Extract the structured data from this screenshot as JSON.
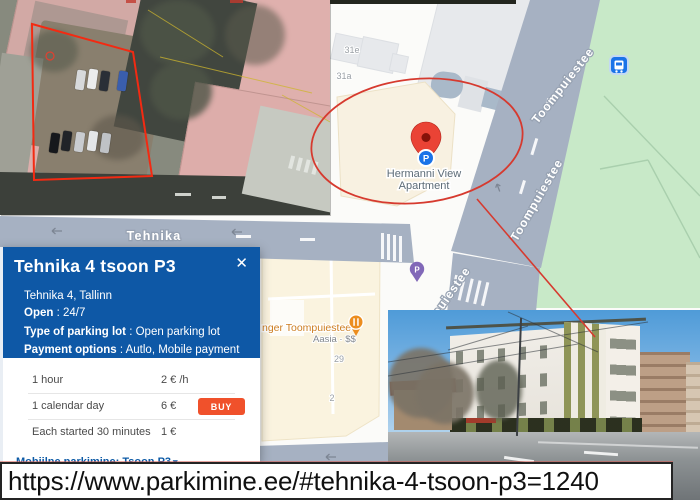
{
  "url_bar": {
    "url": "https://www.parkimine.ee/#tehnika-4-tsoon-p3=1240"
  },
  "map": {
    "street_labels": {
      "tehnika": "Tehnika",
      "toompuiestee_north": "Toompuiestee",
      "toompuiestee_mid": "Toompuiestee",
      "toompuiestee_south": "Toompuiestee"
    },
    "place": {
      "line1": "Hermanni View",
      "line2": "Apartment"
    },
    "restaurant": {
      "name_visible": "nger Toompuiestee",
      "subtitle": "Aasia · $$"
    },
    "addresses": {
      "b31e": "31e",
      "b31a": "31a",
      "b29": "29",
      "b2": "2"
    },
    "parking_pin_letter": "P"
  },
  "card": {
    "title": "Tehnika 4 tsoon P3",
    "close_glyph": "✕",
    "address": "Tehnika 4, Tallinn",
    "sep": " : ",
    "fields": [
      {
        "label": "Open",
        "value": "24/7"
      },
      {
        "label": "Type of parking lot",
        "value": "Open parking lot"
      },
      {
        "label": "Payment options",
        "value": "Autlo, Mobile payment"
      }
    ],
    "prices": [
      {
        "label": "1 hour",
        "value": "2 € /h"
      },
      {
        "label": "1 calendar day",
        "value": "6 €",
        "action": "BUY"
      },
      {
        "label": "Each started 30 minutes",
        "value": "1 €"
      }
    ],
    "link_label": "Mobiilne parkimine: Tsoon P3",
    "link_chevron": "▾"
  },
  "colors": {
    "card_header_blue": "#0e58a6",
    "buy_orange": "#f0512b",
    "annotation_red": "#d63a2f",
    "map_street": "#a6b1c2",
    "map_green": "#c8e9c8",
    "pin_red": "#ea4335",
    "pin_blue": "#1a73e8",
    "pin_purple": "#8168b8",
    "pin_orange": "#ec8d1e"
  }
}
